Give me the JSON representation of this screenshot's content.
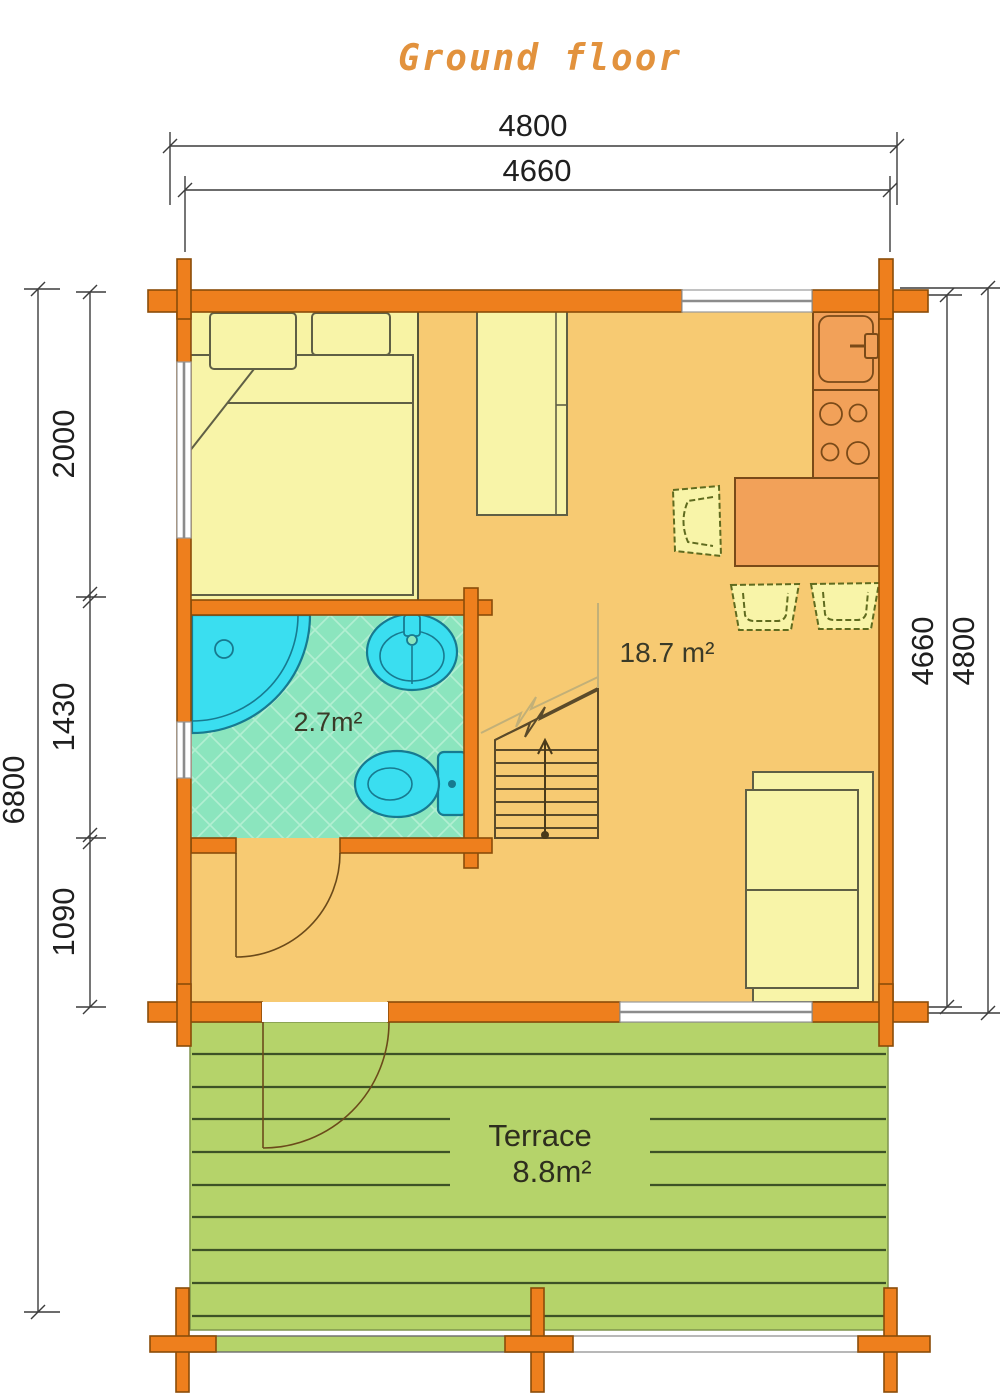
{
  "title": "Ground floor",
  "dimensions": {
    "top_outer": "4800",
    "top_inner": "4660",
    "left_total": "6800",
    "left_upper": "2000",
    "left_middle": "1430",
    "left_lower": "1090",
    "right_inner": "4660",
    "right_outer": "4800"
  },
  "rooms": {
    "living": {
      "area_label": "18.7 m²"
    },
    "bathroom": {
      "area_label": "2.7m²"
    },
    "terrace": {
      "name_label": "Terrace",
      "area_label": "8.8m²"
    }
  },
  "icons": {
    "shower": "shower-icon",
    "washbasin": "washbasin-icon",
    "toilet": "toilet-icon",
    "kitchen_sink": "kitchen-sink-icon",
    "stove": "stove-icon",
    "stairs_up_arrow": "up-arrow-icon"
  },
  "colors": {
    "wall": "#EE7F1D",
    "living_floor": "#F7CA72",
    "bedroom_floor": "#F8F3A4",
    "furniture": "#F8F4A8",
    "kitchen_furniture": "#F2A159",
    "bathroom_tile": "#8BE5BE",
    "fixture_cyan": "#3ADEF0",
    "terrace_green": "#B5D36A",
    "title_orange": "#e2923d",
    "dimension_text": "#1f1f1f"
  }
}
